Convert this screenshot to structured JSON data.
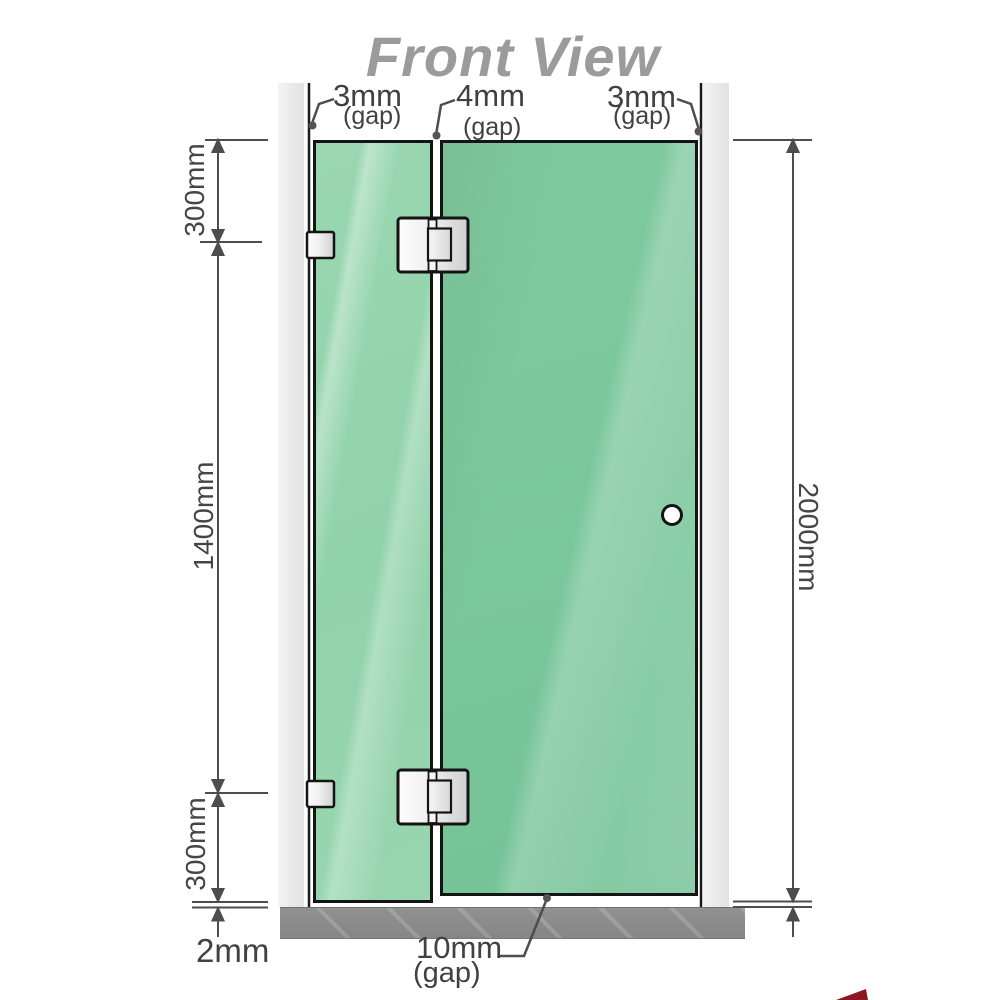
{
  "title": "Front View",
  "annotations": {
    "gap_top_left": {
      "value": "3mm",
      "qualifier": "(gap)"
    },
    "gap_top_middle": {
      "value": "4mm",
      "qualifier": "(gap)"
    },
    "gap_top_right": {
      "value": "3mm",
      "qualifier": "(gap)"
    },
    "panel_top_height": "300mm",
    "panel_middle_height": "1400mm",
    "panel_bottom_height": "300mm",
    "total_height": "2000mm",
    "floor_gap": "2mm",
    "door_bottom_gap": {
      "value": "10mm",
      "qualifier": "(gap)"
    }
  },
  "colors": {
    "glass_fixed": "#98d5af",
    "glass_door": "#7cc79d",
    "frame_outline": "#141414",
    "dimension_gray": "#4d4d4d",
    "title_gray": "#9b9b9b",
    "wall_channel_gray": "#ebebeb",
    "floor_gray": "#8d8d8d",
    "accent_red": "#8c1622"
  }
}
